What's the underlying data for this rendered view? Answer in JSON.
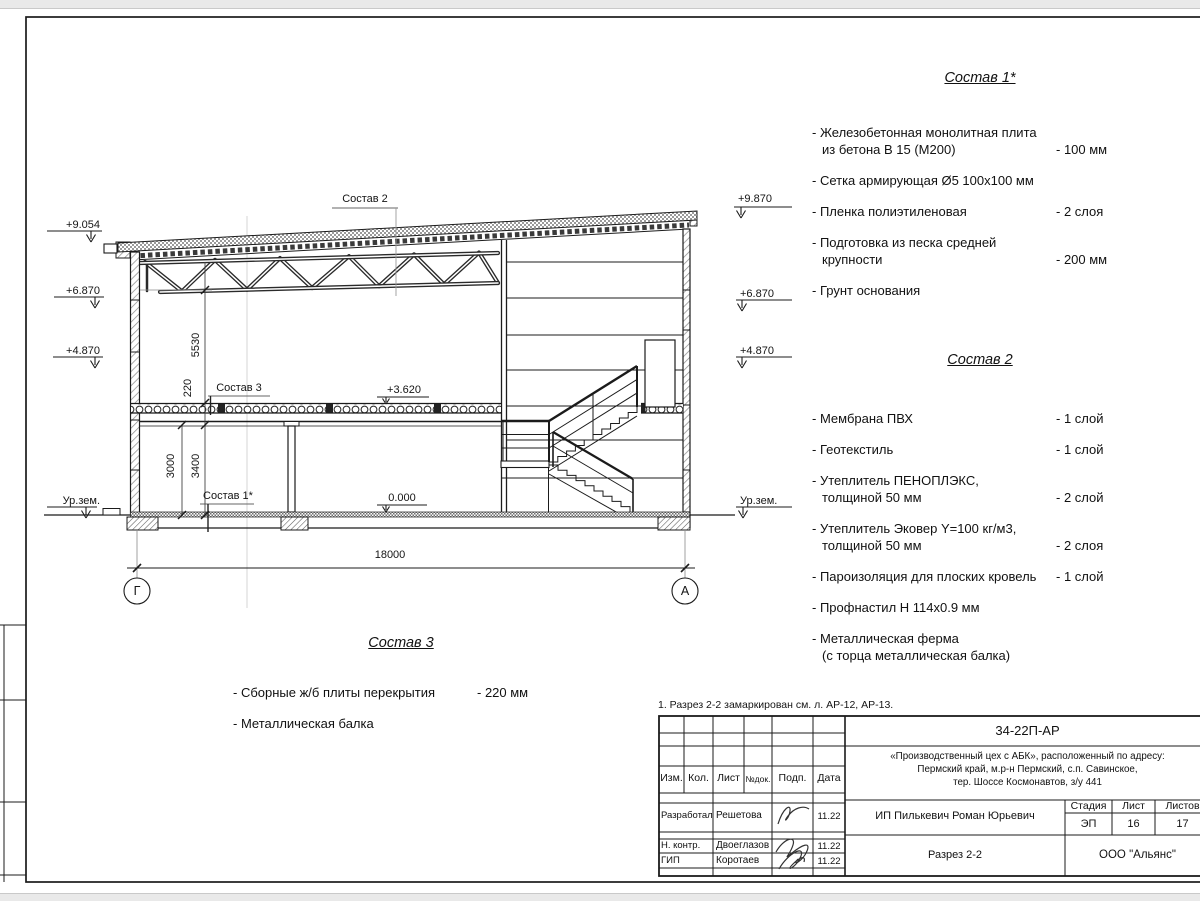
{
  "drawing": {
    "leader_top": "Состав 2",
    "leader_slab": "Состав 3",
    "leader_floor": "Состав 1*",
    "level_slab": "+3.620",
    "level_floor": "0.000",
    "levels_left": [
      "+9.054",
      "+6.870",
      "+4.870",
      "Ур.зем."
    ],
    "levels_right": [
      "+9.870",
      "+6.870",
      "+4.870",
      "Ур.зем."
    ],
    "dim_truss": "5530",
    "dim_slab": "220",
    "dim_3000": "3000",
    "dim_3400": "3400",
    "dim_span": "18000",
    "axis_left": "Г",
    "axis_right": "А"
  },
  "sostav1": {
    "title": "Состав 1*",
    "items": [
      {
        "l1": "- Железобетонная  монолитная плита",
        "l2": "из бетона В 15 (М200)",
        "val": "- 100 мм"
      },
      {
        "l1": "- Сетка армирующая Ø5 100x100 мм"
      },
      {
        "l1": "- Пленка полиэтиленовая",
        "val": "-  2 слоя"
      },
      {
        "l1": "- Подготовка из песка средней",
        "l2": "крупности",
        "val": "- 200 мм"
      },
      {
        "l1": "- Грунт основания"
      }
    ]
  },
  "sostav2": {
    "title": "Состав 2",
    "items": [
      {
        "l1": "- Мембрана ПВХ",
        "val": "- 1 слой"
      },
      {
        "l1": "- Геотекстиль",
        "val": "- 1 слой"
      },
      {
        "l1": "- Утеплитель ПЕНОПЛЭКС,",
        "l2": "толщиной 50 мм",
        "val": "- 2 слой"
      },
      {
        "l1": "- Утеплитель Эковер Y=100 кг/м3,",
        "l2": "толщиной 50 мм",
        "val": "- 2 слоя"
      },
      {
        "l1": "- Пароизоляция для плоских кровель",
        "val": "- 1 слой"
      },
      {
        "l1": "- Профнастил Н 114x0.9 мм"
      },
      {
        "l1": "- Металлическая ферма",
        "l2": "(с торца металлическая балка)"
      }
    ]
  },
  "sostav3": {
    "title": "Состав 3",
    "items": [
      {
        "l1": "- Сборные ж/б  плиты перекрытия",
        "val": "- 220 мм"
      },
      {
        "l1": "- Металлическая балка"
      }
    ]
  },
  "note": "1. Разрез 2-2 замаркирован см. л. АР-12, АР-13.",
  "titleblock": {
    "doc_number": "34-22П-АР",
    "project_lines": [
      "«Производственный цех с АБК», расположенный по адресу:",
      "Пермский край, м.р-н Пермский, с.п. Савинское,",
      "тер. Шоссе Космонавтов, з/у 441"
    ],
    "client": "ИП Пилькевич Роман Юрьевич",
    "sheet_title": "Разрез 2-2",
    "company": "ООО \"Альянс\"",
    "header": {
      "izm": "Изм.",
      "kol": "Кол.",
      "list": "Лист",
      "ndok": "№док.",
      "podp": "Подп.",
      "data": "Дата"
    },
    "stage": {
      "label_stage": "Стадия",
      "label_sheet": "Лист",
      "label_sheets": "Листов",
      "stage": "ЭП",
      "sheet": "16",
      "sheets": "17"
    },
    "rows": [
      {
        "role": "Разработал",
        "name": "Решетова",
        "date": "11.22"
      },
      {
        "role": "Н. контр.",
        "name": "Двоеглазов",
        "date": "11.22"
      },
      {
        "role": "ГИП",
        "name": "Коротаев",
        "date": "11.22"
      }
    ]
  }
}
